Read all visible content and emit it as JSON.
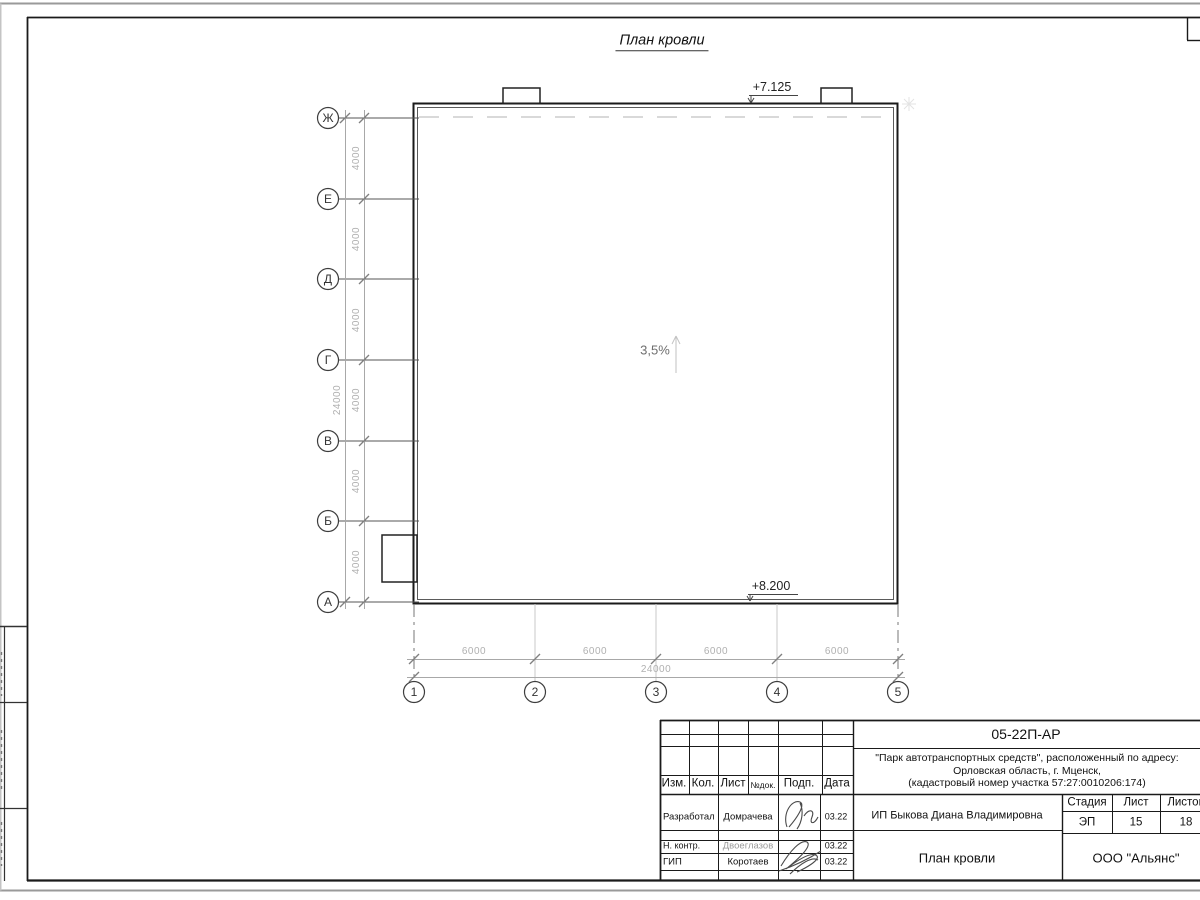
{
  "plan": {
    "title": "План кровли",
    "slope": "3,5%",
    "elev_top": "+7.125",
    "elev_bottom": "+8.200",
    "row_axes": [
      "Ж",
      "Е",
      "Д",
      "Г",
      "В",
      "Б",
      "А"
    ],
    "col_axes": [
      "1",
      "2",
      "3",
      "4",
      "5"
    ],
    "row_spacings": [
      "4000",
      "4000",
      "4000",
      "4000",
      "4000",
      "4000"
    ],
    "row_total": "24000",
    "col_spacings": [
      "6000",
      "6000",
      "6000",
      "6000"
    ],
    "col_total": "24000"
  },
  "titleblock": {
    "doc_code": "05-22П-АР",
    "project_lines": [
      "\"Парк автотранспортных средств\",  расположенный по адресу:",
      "Орловская область, г. Мценск,",
      "(кадастровый номер участка 57:27:0010206:174)"
    ],
    "client": "ИП Быкова Диана Владимировна",
    "drawing_title": "План кровли",
    "company": "ООО \"Альянс\"",
    "header_cols": [
      "Изм.",
      "Кол.",
      "Лист",
      "№док.",
      "Подп.",
      "Дата"
    ],
    "stage_label": "Стадия",
    "sheet_label": "Лист",
    "sheets_label": "Листов",
    "stage_value": "ЭП",
    "sheet_value": "15",
    "sheets_value": "18",
    "signers": [
      {
        "role": "Разработал",
        "name": "Домрачева",
        "date": "03.22"
      },
      {
        "role": "Н. контр.",
        "name": "Двоеглазов",
        "date": "03.22"
      },
      {
        "role": "ГИП",
        "name": "Коротаев",
        "date": "03.22"
      }
    ]
  },
  "colors": {
    "frame": "#1a1a1a",
    "dim_gray": "#b0b0b0"
  }
}
